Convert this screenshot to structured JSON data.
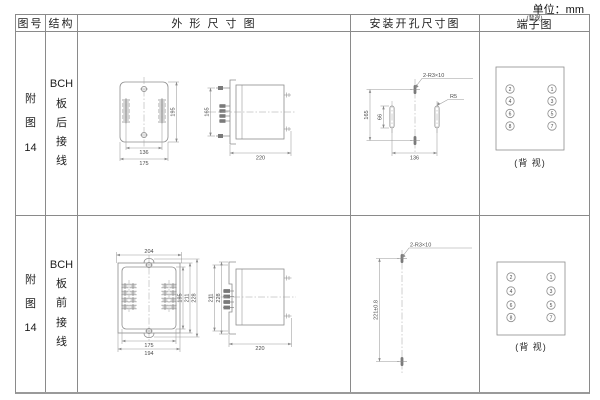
{
  "unit_label": "单位：mm",
  "header": {
    "figure": "图号",
    "structure": "结构",
    "outline": "外 形 尺 寸 图",
    "mounting": "安装开孔尺寸图",
    "terminal": "端子图",
    "terminal_note": "(背视)"
  },
  "rows": [
    {
      "figure_no": "附\n图\n14",
      "structure": "BCH\n板\n后\n接\n线",
      "outline": {
        "front_width_inner": "136",
        "front_width_outer": "175",
        "front_height": "195",
        "side_height": "165",
        "side_depth": "220"
      },
      "mounting": {
        "height": "165",
        "slot_height": "66",
        "width": "136",
        "holes_label": "2-R3×10",
        "radius_label": "R5"
      },
      "terminal": {
        "left_terminals": [
          "2",
          "4",
          "6",
          "8"
        ],
        "right_terminals": [
          "1",
          "3",
          "5",
          "7"
        ],
        "caption": "(背 视)"
      }
    },
    {
      "figure_no": "附\n图\n14",
      "structure": "BCH\n板\n前\n接\n线",
      "outline": {
        "front_width_top": "204",
        "front_width_inner": "175",
        "front_width_outer": "194",
        "front_height_inner": "195",
        "front_height_mid": "211",
        "front_height_outer": "228",
        "side_height_mid": "211",
        "side_height_outer": "228",
        "side_depth": "220"
      },
      "mounting": {
        "height": "221±0.8",
        "holes_label": "2-R3×10"
      },
      "terminal": {
        "left_terminals": [
          "2",
          "4",
          "6",
          "8"
        ],
        "right_terminals": [
          "1",
          "3",
          "5",
          "7"
        ],
        "caption": "(背 视)"
      }
    }
  ]
}
